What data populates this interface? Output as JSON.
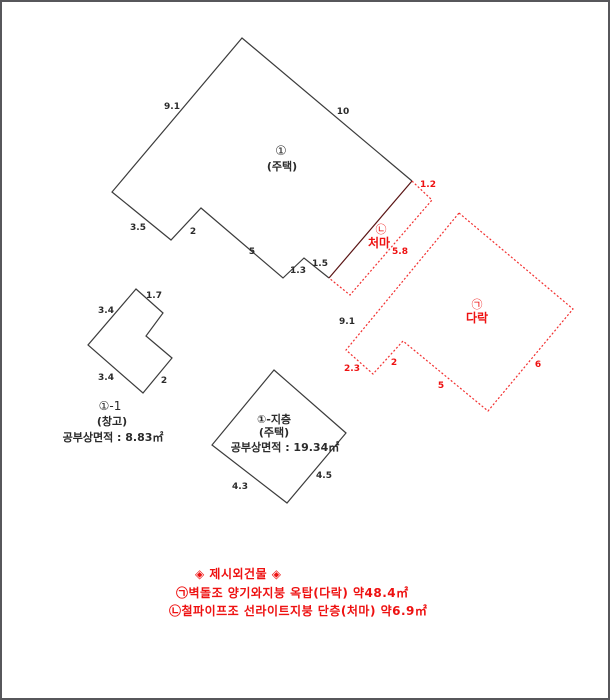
{
  "page": {
    "width": 610,
    "height": 700,
    "background": "#ffffff",
    "border_color": "#57575b"
  },
  "colors": {
    "line_black": "#3c3c3c",
    "line_red": "#f23030",
    "line_dark_red": "#5a1414",
    "text_black": "#2b2b2b",
    "text_red": "#ee1111"
  },
  "legend": {
    "title": "◈ 제시외건물 ◈",
    "attic": "㉠벽돌조 양기와지붕 옥탑(다락) 약48.4㎡",
    "eaves": "㉡철파이프조 선라이트지붕 단층(처마) 약6.9㎡"
  },
  "diagram": {
    "polylines": [
      {
        "name": "main-building-outline",
        "color": "#3c3c3c",
        "dashed": false,
        "closed": false,
        "points": "329,278 304,258 283,278 201,208 171,240 112,192 242,38 412,181"
      },
      {
        "name": "eaves-shared-edge",
        "color": "#5a1414",
        "dashed": false,
        "closed": false,
        "points": "412,181 329,278"
      },
      {
        "name": "eaves-outline",
        "color": "#f23030",
        "dashed": true,
        "closed": false,
        "points": "412,181 432,200 350,295 329,278"
      },
      {
        "name": "attic-outline",
        "color": "#f23030",
        "dashed": true,
        "closed": true,
        "points": "459,213 573,309 488,411 403,341 373,374 346,350"
      },
      {
        "name": "storage-outline",
        "color": "#3c3c3c",
        "dashed": false,
        "closed": true,
        "points": "136,289 163,313 146,336 172,358 143,393 88,345"
      },
      {
        "name": "basement-outline",
        "color": "#3c3c3c",
        "dashed": false,
        "closed": true,
        "points": "274,370 346,433 287,503 212,445"
      }
    ],
    "labels": [
      {
        "name": "dim-main-9-1",
        "text": "9.1",
        "x": 172,
        "y": 109,
        "color": "#2b2b2b",
        "size": 9,
        "bold": true
      },
      {
        "name": "dim-main-10",
        "text": "10",
        "x": 343,
        "y": 114,
        "color": "#2b2b2b",
        "size": 9,
        "bold": true
      },
      {
        "name": "dim-main-3-5",
        "text": "3.5",
        "x": 138,
        "y": 230,
        "color": "#2b2b2b",
        "size": 9,
        "bold": true
      },
      {
        "name": "dim-main-2",
        "text": "2",
        "x": 193,
        "y": 234,
        "color": "#2b2b2b",
        "size": 9,
        "bold": true
      },
      {
        "name": "dim-main-5",
        "text": "5",
        "x": 252,
        "y": 254,
        "color": "#2b2b2b",
        "size": 9,
        "bold": true
      },
      {
        "name": "dim-main-1-3",
        "text": "1.3",
        "x": 298,
        "y": 273,
        "color": "#2b2b2b",
        "size": 9,
        "bold": true
      },
      {
        "name": "dim-main-1-5",
        "text": "1.5",
        "x": 320,
        "y": 266,
        "color": "#2b2b2b",
        "size": 9,
        "bold": true
      },
      {
        "name": "dim-attic-9-1",
        "text": "9.1",
        "x": 347,
        "y": 324,
        "color": "#2b2b2b",
        "size": 9,
        "bold": true
      },
      {
        "name": "dim-storage-1-7",
        "text": "1.7",
        "x": 154,
        "y": 298,
        "color": "#2b2b2b",
        "size": 9,
        "bold": true
      },
      {
        "name": "dim-storage-3-4-top",
        "text": "3.4",
        "x": 106,
        "y": 313,
        "color": "#2b2b2b",
        "size": 9,
        "bold": true
      },
      {
        "name": "dim-storage-3-4-bottom",
        "text": "3.4",
        "x": 106,
        "y": 380,
        "color": "#2b2b2b",
        "size": 9,
        "bold": true
      },
      {
        "name": "dim-storage-2",
        "text": "2",
        "x": 164,
        "y": 383,
        "color": "#2b2b2b",
        "size": 9,
        "bold": true
      },
      {
        "name": "dim-basement-4-3",
        "text": "4.3",
        "x": 240,
        "y": 489,
        "color": "#2b2b2b",
        "size": 9,
        "bold": true
      },
      {
        "name": "dim-basement-4-5",
        "text": "4.5",
        "x": 324,
        "y": 478,
        "color": "#2b2b2b",
        "size": 9,
        "bold": true
      },
      {
        "name": "dim-eaves-1-2",
        "text": "1.2",
        "x": 428,
        "y": 187,
        "color": "#ee1111",
        "size": 9,
        "bold": true
      },
      {
        "name": "dim-eaves-5-8",
        "text": "5.8",
        "x": 400,
        "y": 254,
        "color": "#ee1111",
        "size": 9,
        "bold": true
      },
      {
        "name": "dim-attic-2-3",
        "text": "2.3",
        "x": 352,
        "y": 371,
        "color": "#ee1111",
        "size": 9,
        "bold": true
      },
      {
        "name": "dim-attic-2",
        "text": "2",
        "x": 394,
        "y": 365,
        "color": "#ee1111",
        "size": 9,
        "bold": true
      },
      {
        "name": "dim-attic-5",
        "text": "5",
        "x": 441,
        "y": 388,
        "color": "#ee1111",
        "size": 9,
        "bold": true
      },
      {
        "name": "dim-attic-6",
        "text": "6",
        "x": 538,
        "y": 367,
        "color": "#ee1111",
        "size": 9,
        "bold": true
      },
      {
        "name": "label-main-number",
        "text": "①",
        "x": 281,
        "y": 155,
        "color": "#2b2b2b",
        "size": 13,
        "bold": false
      },
      {
        "name": "label-main-use",
        "text": "(주택)",
        "x": 282,
        "y": 170,
        "color": "#2b2b2b",
        "size": 11,
        "bold": true
      },
      {
        "name": "label-eaves-symbol",
        "text": "㉡",
        "x": 381,
        "y": 233,
        "color": "#ee1111",
        "size": 11,
        "bold": false
      },
      {
        "name": "label-eaves-name",
        "text": "처마",
        "x": 379,
        "y": 247,
        "color": "#ee1111",
        "size": 12,
        "bold": true
      },
      {
        "name": "label-attic-symbol",
        "text": "㉠",
        "x": 477,
        "y": 308,
        "color": "#ee1111",
        "size": 11,
        "bold": false
      },
      {
        "name": "label-attic-name",
        "text": "다락",
        "x": 477,
        "y": 322,
        "color": "#ee1111",
        "size": 12,
        "bold": true
      },
      {
        "name": "label-storage-number",
        "text": "①-1",
        "x": 110,
        "y": 410,
        "color": "#2b2b2b",
        "size": 12,
        "bold": false
      },
      {
        "name": "label-storage-use",
        "text": "(창고)",
        "x": 112,
        "y": 425,
        "color": "#2b2b2b",
        "size": 11,
        "bold": true
      },
      {
        "name": "label-storage-area",
        "text": "공부상면적 : 8.83㎡",
        "x": 113,
        "y": 441,
        "color": "#2b2b2b",
        "size": 11,
        "bold": true
      },
      {
        "name": "label-basement-number",
        "text": "①-지층",
        "x": 274,
        "y": 423,
        "color": "#2b2b2b",
        "size": 11,
        "bold": true
      },
      {
        "name": "label-basement-use",
        "text": "(주택)",
        "x": 274,
        "y": 436,
        "color": "#2b2b2b",
        "size": 11,
        "bold": true
      },
      {
        "name": "label-basement-area",
        "text": "공부상면적 : 19.34㎡",
        "x": 285,
        "y": 451,
        "color": "#2b2b2b",
        "size": 11,
        "bold": true
      }
    ]
  }
}
